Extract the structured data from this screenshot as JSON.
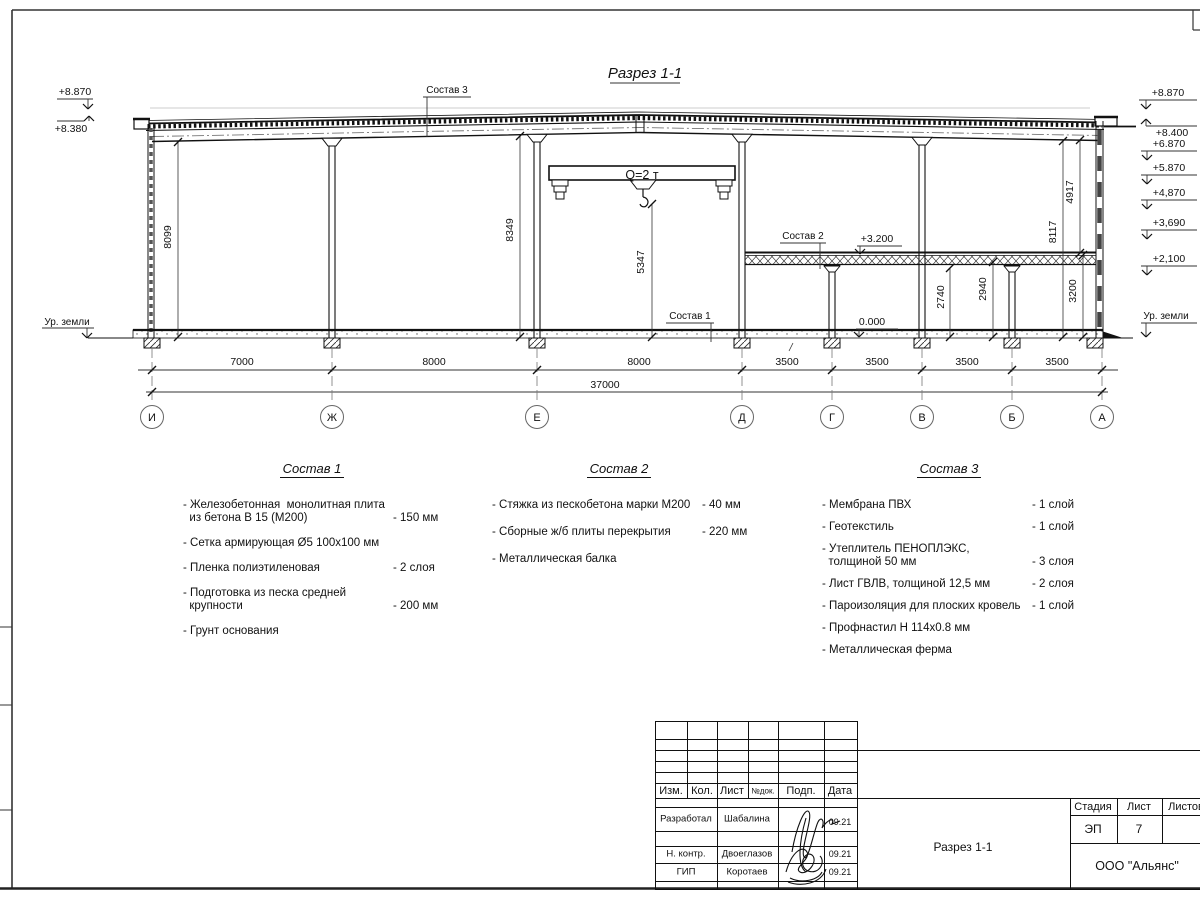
{
  "drawing": {
    "title": "Разрез 1-1",
    "axes": [
      {
        "label": "И",
        "x": 152
      },
      {
        "label": "Ж",
        "x": 332
      },
      {
        "label": "Е",
        "x": 537
      },
      {
        "label": "Д",
        "x": 742
      },
      {
        "label": "Г",
        "x": 832
      },
      {
        "label": "В",
        "x": 922
      },
      {
        "label": "Б",
        "x": 1012
      },
      {
        "label": "А",
        "x": 1102
      }
    ],
    "span_dims": [
      {
        "text": "7000",
        "x": 242
      },
      {
        "text": "8000",
        "x": 434
      },
      {
        "text": "8000",
        "x": 639
      },
      {
        "text": "3500",
        "x": 787
      },
      {
        "text": "3500",
        "x": 877
      },
      {
        "text": "3500",
        "x": 967
      },
      {
        "text": "3500",
        "x": 1057
      }
    ],
    "total_dim": {
      "text": "37000",
      "x": 605,
      "y": 388
    },
    "labels": [
      {
        "name": "section-title",
        "text": "Разрез 1-1",
        "x": 645,
        "y": 78,
        "fs": 15,
        "it": 1
      },
      {
        "name": "leader-label-sostav-3",
        "text": "Состав 3",
        "x": 447,
        "y": 93,
        "fs": 10
      },
      {
        "name": "leader-label-sostav-2",
        "text": "Состав 2",
        "x": 803,
        "y": 239,
        "fs": 10
      },
      {
        "name": "leader-label-sostav-1",
        "text": "Состав 1",
        "x": 690,
        "y": 319,
        "fs": 10
      },
      {
        "name": "crane-capacity-label",
        "text": "Q=2 т",
        "x": 642,
        "y": 179,
        "fs": 12.5
      },
      {
        "name": "elev-left-top",
        "text": "+8.870",
        "x": 75,
        "y": 95
      },
      {
        "name": "elev-left-eave",
        "text": "+8.380",
        "x": 71,
        "y": 132
      },
      {
        "name": "ground-level-left",
        "text": "Ур. земли",
        "x": 67,
        "y": 325,
        "fs": 10
      },
      {
        "name": "elev-right-8870",
        "text": "+8.870",
        "x": 1168,
        "y": 96
      },
      {
        "name": "elev-right-8400",
        "text": "+8.400",
        "x": 1172,
        "y": 136
      },
      {
        "name": "elev-right-6870",
        "text": "+6.870",
        "x": 1169,
        "y": 147
      },
      {
        "name": "elev-right-5870",
        "text": "+5.870",
        "x": 1169,
        "y": 171
      },
      {
        "name": "elev-right-4870",
        "text": "+4,870",
        "x": 1169,
        "y": 196
      },
      {
        "name": "elev-right-3690",
        "text": "+3,690",
        "x": 1169,
        "y": 226
      },
      {
        "name": "elev-right-2100",
        "text": "+2,100",
        "x": 1169,
        "y": 262
      },
      {
        "name": "ground-level-right",
        "text": "Ур. земли",
        "x": 1166,
        "y": 319,
        "fs": 10
      },
      {
        "name": "elev-floor-3200",
        "text": "+3.200",
        "x": 877,
        "y": 242
      },
      {
        "name": "elev-floor-0000",
        "text": "0.000",
        "x": 872,
        "y": 325
      },
      {
        "name": "dim-8099",
        "text": "8099",
        "x": 171,
        "y": 237,
        "rot": 1
      },
      {
        "name": "dim-8349",
        "text": "8349",
        "x": 513,
        "y": 230,
        "rot": 1
      },
      {
        "name": "dim-5347",
        "text": "5347",
        "x": 644,
        "y": 262,
        "rot": 1
      },
      {
        "name": "dim-2740",
        "text": "2740",
        "x": 944,
        "y": 297,
        "rot": 1
      },
      {
        "name": "dim-2940",
        "text": "2940",
        "x": 986,
        "y": 289,
        "rot": 1
      },
      {
        "name": "dim-3200",
        "text": "3200",
        "x": 1076,
        "y": 291,
        "rot": 1
      },
      {
        "name": "dim-8117",
        "text": "8117",
        "x": 1056,
        "y": 232,
        "rot": 1
      },
      {
        "name": "dim-4917",
        "text": "4917",
        "x": 1073,
        "y": 192,
        "rot": 1
      }
    ]
  },
  "compositions": [
    {
      "title": "Состав 1",
      "items": [
        {
          "name": "- Железобетонная  монолитная плита\n  из бетона В 15 (М200)",
          "value": "- 150 мм"
        },
        {
          "name": "- Сетка армирующая Ø5 100х100 мм",
          "value": ""
        },
        {
          "name": "- Пленка полиэтиленовая",
          "value": "-  2 слоя"
        },
        {
          "name": "- Подготовка из песка средней\n  крупности",
          "value": "- 200 мм"
        },
        {
          "name": "- Грунт основания",
          "value": ""
        }
      ]
    },
    {
      "title": "Состав 2",
      "items": [
        {
          "name": "- Стяжка из пескобетона марки М200",
          "value": "- 40 мм"
        },
        {
          "name": "- Сборные ж/б плиты перекрытия",
          "value": "- 220 мм"
        },
        {
          "name": "- Металлическая балка",
          "value": ""
        }
      ]
    },
    {
      "title": "Состав 3",
      "items": [
        {
          "name": "- Мембрана ПВХ",
          "value": "- 1 слой"
        },
        {
          "name": "- Геотекстиль",
          "value": "- 1 слой"
        },
        {
          "name": "- Утеплитель ПЕНОПЛЭКС,\n  толщиной 50 мм",
          "value": "- 3 слоя"
        },
        {
          "name": "- Лист ГВЛВ, толщиной 12,5 мм",
          "value": "- 2 слоя"
        },
        {
          "name": "- Пароизоляция для плоских кровель",
          "value": "- 1 слой"
        },
        {
          "name": "- Профнастил Н 114х0.8 мм",
          "value": ""
        },
        {
          "name": "- Металлическая ферма",
          "value": ""
        }
      ]
    }
  ],
  "titleblock": {
    "header_cols": [
      "Изм.",
      "Кол.",
      "Лист",
      "№док.",
      "Подп.",
      "Дата"
    ],
    "rows": [
      {
        "role": "Разработал",
        "name": "Шабалина",
        "date": "09.21"
      },
      {
        "role": "Н. контр.",
        "name": "Двоеглазов",
        "date": "09.21"
      },
      {
        "role": "ГИП",
        "name": "Коротаев",
        "date": "09.21"
      }
    ],
    "stage_label": "Стадия",
    "sheet_label": "Лист",
    "sheets_label": "Листов",
    "stage": "ЭП",
    "sheet": "7",
    "doc_name": "Разрез 1-1",
    "company": "ООО \"Альянс\""
  }
}
